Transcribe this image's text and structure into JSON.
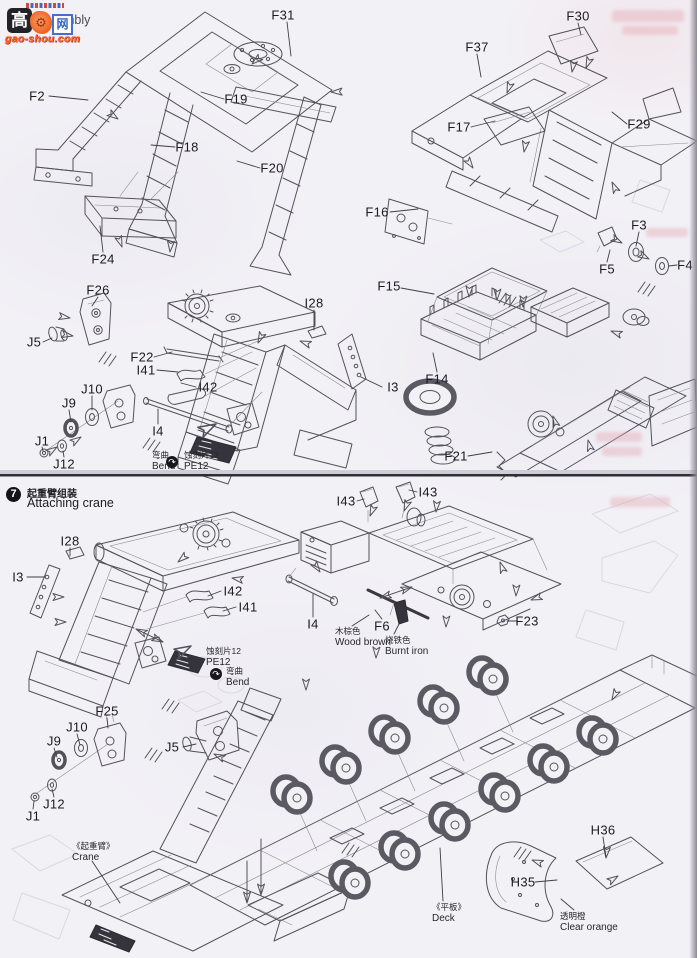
{
  "page": {
    "width": 697,
    "height": 958,
    "paper_color": "#f2f1f6",
    "ink_color": "#53525a",
    "label_color": "#1b1b20",
    "divider_color": "#2f2e35"
  },
  "watermark": {
    "char_left": "高",
    "char_right": "网",
    "site": "gao-shou.com",
    "gear_glyph": "⚙",
    "tile_color": "#1a1a1f",
    "accent_color": "#f05a1e",
    "box_border_color": "#3a6cc8"
  },
  "step6": {
    "title_fragment": "embly"
  },
  "step7": {
    "number": "7",
    "title_zh": "起重臂组装",
    "title_en": "Attaching crane"
  },
  "icons": {
    "bend_glyph": "↷"
  },
  "part_labels": [
    {
      "text": "F31",
      "x": 283,
      "y": 15,
      "leader": [
        287,
        22,
        291,
        56
      ]
    },
    {
      "text": "F2",
      "x": 37,
      "y": 96,
      "leader": [
        49,
        96,
        88,
        100
      ]
    },
    {
      "text": "F19",
      "x": 236,
      "y": 99,
      "leader": [
        224,
        99,
        201,
        92
      ]
    },
    {
      "text": "F18",
      "x": 187,
      "y": 147,
      "leader": [
        175,
        147,
        151,
        145
      ]
    },
    {
      "text": "F20",
      "x": 272,
      "y": 168,
      "leader": [
        260,
        168,
        237,
        161
      ]
    },
    {
      "text": "F24",
      "x": 103,
      "y": 259,
      "leader": [
        103,
        252,
        100,
        226
      ]
    },
    {
      "text": "F26",
      "x": 98,
      "y": 290,
      "leader": [
        98,
        297,
        92,
        306
      ]
    },
    {
      "text": "J5",
      "x": 34,
      "y": 342,
      "leader": [
        43,
        342,
        52,
        338
      ]
    },
    {
      "text": "F22",
      "x": 142,
      "y": 357,
      "leader": [
        154,
        357,
        172,
        352
      ]
    },
    {
      "text": "I41",
      "x": 146,
      "y": 370,
      "leader": [
        157,
        370,
        178,
        372
      ]
    },
    {
      "text": "I42",
      "x": 208,
      "y": 387,
      "leader": [
        196,
        387,
        181,
        383
      ]
    },
    {
      "text": "I4",
      "x": 158,
      "y": 431,
      "leader": [
        158,
        424,
        158,
        409
      ]
    },
    {
      "text": "J10",
      "x": 92,
      "y": 389,
      "leader": [
        92,
        396,
        92,
        410
      ]
    },
    {
      "text": "J9",
      "x": 69,
      "y": 403,
      "leader": [
        69,
        410,
        71,
        422
      ]
    },
    {
      "text": "J1",
      "x": 42,
      "y": 441,
      "leader": [
        42,
        447,
        43,
        451
      ]
    },
    {
      "text": "J12",
      "x": 64,
      "y": 464,
      "leader": [
        64,
        457,
        63,
        451
      ]
    },
    {
      "text": "I28",
      "x": 314,
      "y": 303,
      "leader": [
        314,
        310,
        314,
        330
      ]
    },
    {
      "text": "F15",
      "x": 389,
      "y": 286,
      "leader": [
        401,
        288,
        434,
        294
      ]
    },
    {
      "text": "F14",
      "x": 437,
      "y": 379,
      "leader": [
        437,
        372,
        433,
        353
      ]
    },
    {
      "text": "I3",
      "x": 393,
      "y": 387,
      "leader": [
        382,
        387,
        361,
        377
      ]
    },
    {
      "text": "F16",
      "x": 377,
      "y": 212,
      "leader": [
        390,
        212,
        418,
        209
      ]
    },
    {
      "text": "F37",
      "x": 477,
      "y": 47,
      "leader": [
        477,
        54,
        481,
        77
      ]
    },
    {
      "text": "F30",
      "x": 578,
      "y": 16,
      "leader": [
        578,
        23,
        581,
        35
      ]
    },
    {
      "text": "F17",
      "x": 459,
      "y": 127,
      "leader": [
        471,
        127,
        495,
        121
      ]
    },
    {
      "text": "F29",
      "x": 639,
      "y": 124,
      "leader": [
        627,
        124,
        612,
        112
      ]
    },
    {
      "text": "F3",
      "x": 639,
      "y": 225,
      "leader": [
        639,
        232,
        636,
        246
      ]
    },
    {
      "text": "F5",
      "x": 607,
      "y": 269,
      "leader": [
        607,
        262,
        610,
        250
      ]
    },
    {
      "text": "F4",
      "x": 685,
      "y": 265,
      "leader": [
        677,
        265,
        669,
        266
      ]
    },
    {
      "text": "F21",
      "x": 456,
      "y": 456,
      "leader": [
        468,
        456,
        492,
        452
      ]
    },
    {
      "text": "I43",
      "x": 346,
      "y": 501,
      "leader": [
        357,
        501,
        364,
        499
      ]
    },
    {
      "text": "I43",
      "x": 428,
      "y": 492,
      "leader": [
        417,
        492,
        409,
        490
      ]
    },
    {
      "text": "I28",
      "x": 70,
      "y": 541,
      "leader": [
        70,
        548,
        70,
        556
      ]
    },
    {
      "text": "I3",
      "x": 18,
      "y": 577,
      "leader": [
        27,
        577,
        45,
        577
      ]
    },
    {
      "text": "I42",
      "x": 233,
      "y": 591,
      "leader": [
        221,
        591,
        208,
        596
      ]
    },
    {
      "text": "I41",
      "x": 248,
      "y": 607,
      "leader": [
        236,
        607,
        223,
        611
      ]
    },
    {
      "text": "I4",
      "x": 313,
      "y": 624,
      "leader": [
        313,
        617,
        313,
        594
      ]
    },
    {
      "text": "F6",
      "x": 382,
      "y": 626,
      "leader": [
        382,
        619,
        375,
        610
      ]
    },
    {
      "text": "F23",
      "x": 527,
      "y": 621,
      "leader": [
        516,
        621,
        507,
        621
      ]
    },
    {
      "text": "F25",
      "x": 107,
      "y": 711,
      "leader": [
        107,
        718,
        108,
        728
      ]
    },
    {
      "text": "J10",
      "x": 77,
      "y": 727,
      "leader": [
        77,
        734,
        80,
        745
      ]
    },
    {
      "text": "J9",
      "x": 54,
      "y": 741,
      "leader": [
        54,
        748,
        57,
        757
      ]
    },
    {
      "text": "J5",
      "x": 172,
      "y": 747,
      "leader": [
        183,
        747,
        196,
        744
      ]
    },
    {
      "text": "J12",
      "x": 54,
      "y": 804,
      "leader": [
        54,
        797,
        52,
        789
      ]
    },
    {
      "text": "J1",
      "x": 33,
      "y": 816,
      "leader": [
        33,
        809,
        34,
        801
      ]
    },
    {
      "text": "H36",
      "x": 603,
      "y": 830,
      "leader": [
        603,
        837,
        606,
        857
      ]
    },
    {
      "text": "H35",
      "x": 523,
      "y": 882,
      "leader": [
        535,
        882,
        557,
        880
      ]
    }
  ],
  "annotations": [
    {
      "zh": "弯曲",
      "en": "Bend",
      "x": 152,
      "y": 451
    },
    {
      "zh": "蚀刻片12",
      "en": "PE12",
      "x": 184,
      "y": 451
    },
    {
      "zh": "蚀刻片12",
      "en": "PE12",
      "x": 206,
      "y": 647
    },
    {
      "zh": "弯曲",
      "en": "Bend",
      "x": 226,
      "y": 667
    },
    {
      "zh": "木棕色",
      "en": "Wood brown",
      "x": 335,
      "y": 627
    },
    {
      "zh": "烧铁色",
      "en": "Burnt iron",
      "x": 385,
      "y": 636
    },
    {
      "zh": "《起重臂》",
      "en": "Crane",
      "x": 72,
      "y": 842
    },
    {
      "zh": "《平板》",
      "en": "Deck",
      "x": 432,
      "y": 903
    },
    {
      "zh": "透明橙",
      "en": "Clear orange",
      "x": 560,
      "y": 912
    }
  ],
  "bend_icons": [
    {
      "x": 172,
      "y": 462
    },
    {
      "x": 216,
      "y": 674
    }
  ]
}
